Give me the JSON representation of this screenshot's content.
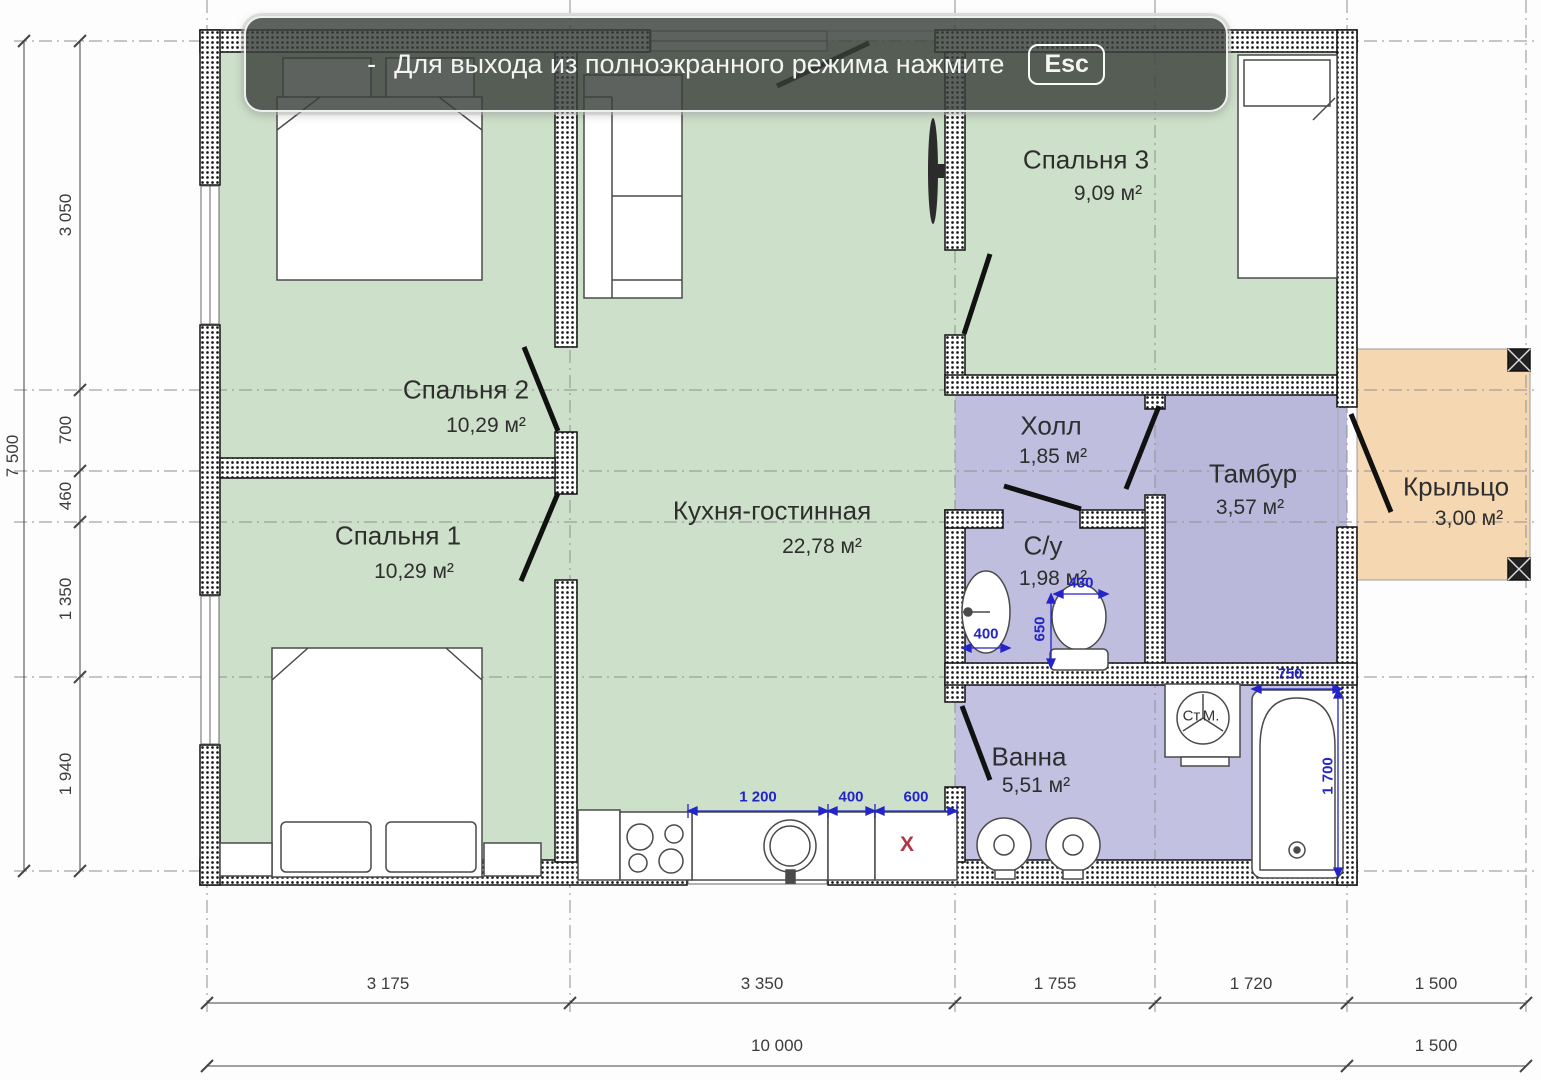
{
  "banner": {
    "dash": "-",
    "message": "Для выхода из полноэкранного режима нажмите",
    "key": "Esc"
  },
  "rooms": {
    "bedroom2": {
      "name": "Спальня 2",
      "area": "10,29 м²"
    },
    "bedroom1": {
      "name": "Спальня 1",
      "area": "10,29 м²"
    },
    "bedroom3": {
      "name": "Спальня 3",
      "area": "9,09 м²"
    },
    "kitchen_living": {
      "name": "Кухня-гостинная",
      "area": "22,78 м²"
    },
    "hall": {
      "name": "Холл",
      "area": "1,85 м²"
    },
    "vestibule": {
      "name": "Тамбур",
      "area": "3,57 м²"
    },
    "wc": {
      "name": "С/у",
      "area": "1,98 м²"
    },
    "bathroom": {
      "name": "Ванна",
      "area": "5,51 м²"
    },
    "porch": {
      "name": "Крыльцо",
      "area": "3,00 м²"
    }
  },
  "fixtures": {
    "washing_machine": "Ст.М.",
    "removed_marker": "Х"
  },
  "dimensions": {
    "vertical_total": "7 500",
    "vertical": [
      "3 050",
      "700",
      "460",
      "1 350",
      "1 940"
    ],
    "horizontal": [
      "3 175",
      "3 350",
      "1 755",
      "1 720",
      "1 500"
    ],
    "horizontal_total": "10 000",
    "horizontal_porch": "1 500",
    "kitchen": [
      "1 200",
      "400",
      "600"
    ],
    "wc": {
      "sink_width": "400",
      "toilet_width": "430",
      "toilet_depth": "650"
    },
    "bath": {
      "tub_width": "750",
      "tub_length": "1 700"
    }
  },
  "colors": {
    "room_green": "#cde0c9",
    "room_purple": "#bfbedf",
    "porch_tan": "#f5d8b2",
    "dim_blue": "#2424c8",
    "marker_red": "#b03545"
  }
}
